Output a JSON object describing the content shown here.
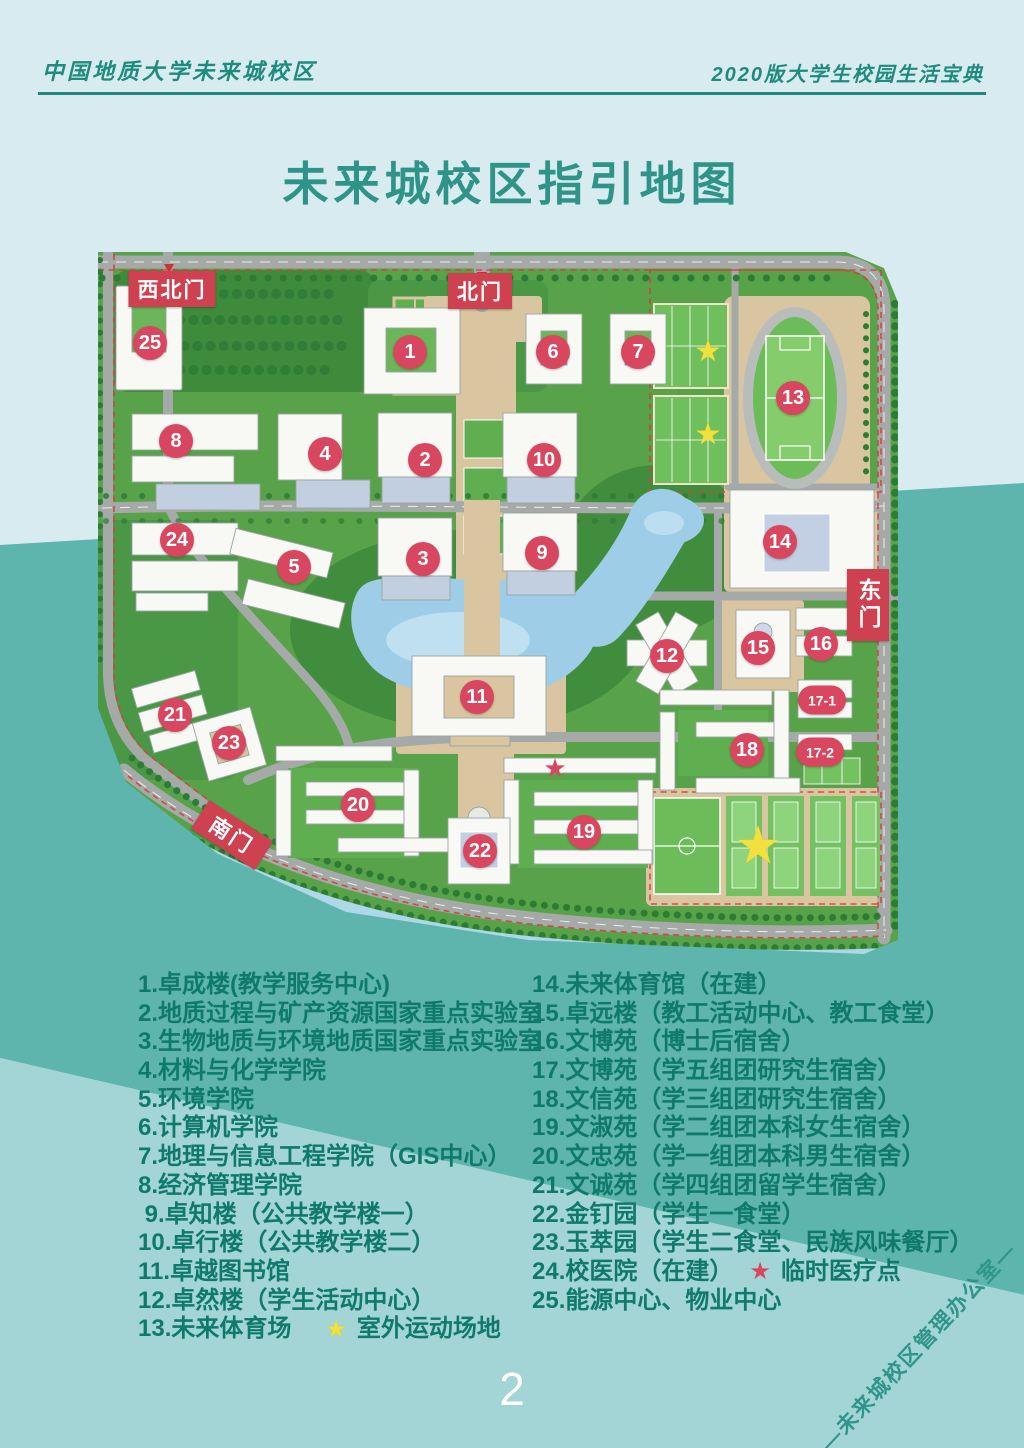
{
  "header": {
    "left": "中国地质大学未来城校区",
    "right": "2020版大学生校园生活宝典"
  },
  "title": "未来城校区指引地图",
  "page_number": "2",
  "watermark": "—未来城校区管理办公室—",
  "colors": {
    "accent_teal": "#2e9488",
    "legend_text": "#0f7a6c",
    "marker_red": "#d8465f",
    "gate_red": "#ce4150",
    "star_yellow": "#f2e03c",
    "star_red": "#d8465f"
  },
  "map": {
    "gates": [
      {
        "id": "northwest",
        "label": "西北门",
        "x": 74,
        "y": 49
      },
      {
        "id": "north",
        "label": "北门",
        "x": 382,
        "y": 51
      },
      {
        "id": "east",
        "label": "东门",
        "x": 770,
        "y": 365
      },
      {
        "id": "south",
        "label": "南门",
        "x": 134,
        "y": 595
      }
    ],
    "markers": [
      {
        "label": "1",
        "x": 312,
        "y": 112
      },
      {
        "label": "2",
        "x": 327,
        "y": 220
      },
      {
        "label": "3",
        "x": 325,
        "y": 319
      },
      {
        "label": "4",
        "x": 227,
        "y": 214
      },
      {
        "label": "5",
        "x": 196,
        "y": 327
      },
      {
        "label": "6",
        "x": 455,
        "y": 112
      },
      {
        "label": "7",
        "x": 540,
        "y": 112
      },
      {
        "label": "8",
        "x": 78,
        "y": 201
      },
      {
        "label": "9",
        "x": 444,
        "y": 313
      },
      {
        "label": "10",
        "x": 446,
        "y": 220
      },
      {
        "label": "11",
        "x": 379,
        "y": 457
      },
      {
        "label": "12",
        "x": 569,
        "y": 416
      },
      {
        "label": "13",
        "x": 695,
        "y": 158
      },
      {
        "label": "14",
        "x": 682,
        "y": 302
      },
      {
        "label": "15",
        "x": 660,
        "y": 408
      },
      {
        "label": "16",
        "x": 723,
        "y": 404
      },
      {
        "label": "17-1",
        "x": 724,
        "y": 460
      },
      {
        "label": "17-2",
        "x": 722,
        "y": 512
      },
      {
        "label": "18",
        "x": 649,
        "y": 510
      },
      {
        "label": "19",
        "x": 486,
        "y": 592
      },
      {
        "label": "20",
        "x": 260,
        "y": 565
      },
      {
        "label": "21",
        "x": 77,
        "y": 475
      },
      {
        "label": "22",
        "x": 382,
        "y": 611
      },
      {
        "label": "23",
        "x": 131,
        "y": 503
      },
      {
        "label": "24",
        "x": 79,
        "y": 300
      },
      {
        "label": "25",
        "x": 52,
        "y": 103
      }
    ],
    "stars": [
      {
        "color": "yellow",
        "x": 610,
        "y": 112,
        "size": 30
      },
      {
        "color": "yellow",
        "x": 610,
        "y": 195,
        "size": 30
      },
      {
        "color": "yellow",
        "x": 660,
        "y": 606,
        "size": 52
      },
      {
        "color": "red",
        "x": 457,
        "y": 528,
        "size": 26
      }
    ]
  },
  "legend": {
    "left": [
      {
        "text": "1.卓成楼(教学服务中心)"
      },
      {
        "text": "2.地质过程与矿产资源国家重点实验室"
      },
      {
        "text": "3.生物地质与环境地质国家重点实验室"
      },
      {
        "text": "4.材料与化学学院"
      },
      {
        "text": "5.环境学院"
      },
      {
        "text": "6.计算机学院"
      },
      {
        "text": "7.地理与信息工程学院（GIS中心）"
      },
      {
        "text": "8.经济管理学院"
      },
      {
        "text": " 9.卓知楼（公共教学楼一）"
      },
      {
        "text": "10.卓行楼（公共教学楼二）"
      },
      {
        "text": "11.卓越图书馆"
      },
      {
        "text": "12.卓然楼（学生活动中心）"
      },
      {
        "text": "13.未来体育场",
        "star": "yellow",
        "suffix": "室外运动场地"
      }
    ],
    "right": [
      {
        "text": "14.未来体育馆（在建）"
      },
      {
        "text": "15.卓远楼（教工活动中心、教工食堂）"
      },
      {
        "text": "16.文博苑（博士后宿舍）"
      },
      {
        "text": "17.文博苑（学五组团研究生宿舍）"
      },
      {
        "text": "18.文信苑（学三组团研究生宿舍）"
      },
      {
        "text": "19.文淑苑（学二组团本科女生宿舍）"
      },
      {
        "text": "20.文忠苑（学一组团本科男生宿舍）"
      },
      {
        "text": "21.文诚苑（学四组团留学生宿舍）"
      },
      {
        "text": "22.金钉园（学生一食堂）"
      },
      {
        "text": "23.玉萃园（学生二食堂、民族风味餐厅）"
      },
      {
        "text": "24.校医院（在建）",
        "star": "red",
        "suffix": "临时医疗点"
      },
      {
        "text": "25.能源中心、物业中心"
      }
    ]
  }
}
